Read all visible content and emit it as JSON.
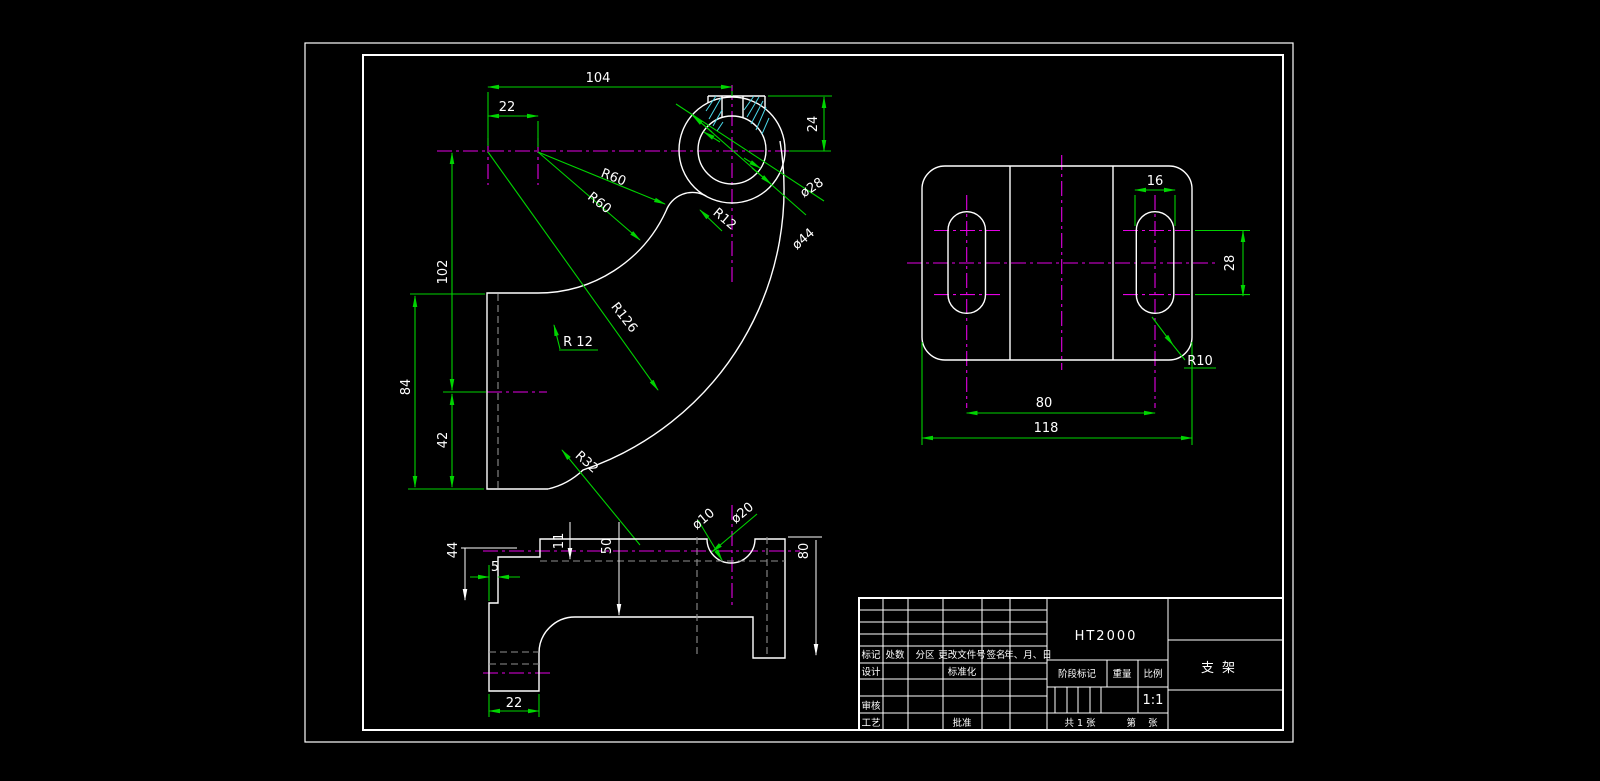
{
  "colors": {
    "background": "#000000",
    "outline": "#ffffff",
    "dimension_lines": "#00d400",
    "centerlines": "#e400e4",
    "hidden_lines": "#8f8f8f",
    "hatch": "#49d7e8"
  },
  "front": {
    "dim104": "104",
    "dim22": "22",
    "dim24": "24",
    "dim102": "102",
    "dim84": "84",
    "dim42": "42",
    "r60_1": "R60",
    "r60_2": "R60",
    "r12_boss": "R12",
    "r12_body": "R 12",
    "r126": "R126",
    "r32": "R32",
    "dia28": "ø28",
    "dia44": "ø44"
  },
  "top": {
    "dim16": "16",
    "dim28": "28",
    "dim80": "80",
    "dim118": "118",
    "r10": "R10"
  },
  "bottom": {
    "dim44": "44",
    "dim5": "5",
    "dim11": "11",
    "dim50": "50",
    "dim80": "80",
    "dim22": "22",
    "dia10": "ø10",
    "dia20": "ø20"
  },
  "titleblock": {
    "material": "HT2000",
    "part_name": "支架",
    "scale_value": "1:1",
    "labels": {
      "mark": "标记",
      "count": "处数",
      "zone": "分区",
      "change_doc": "更改文件号",
      "signature": "签名",
      "date": "年、月、日",
      "design": "设计",
      "standardization": "标准化",
      "audit": "审核",
      "process": "工艺",
      "approve": "批准",
      "stage_mark": "阶段标记",
      "weight": "重量",
      "scale": "比例",
      "sheets_total": "共 1 张",
      "sheet_no": "第    张"
    }
  }
}
